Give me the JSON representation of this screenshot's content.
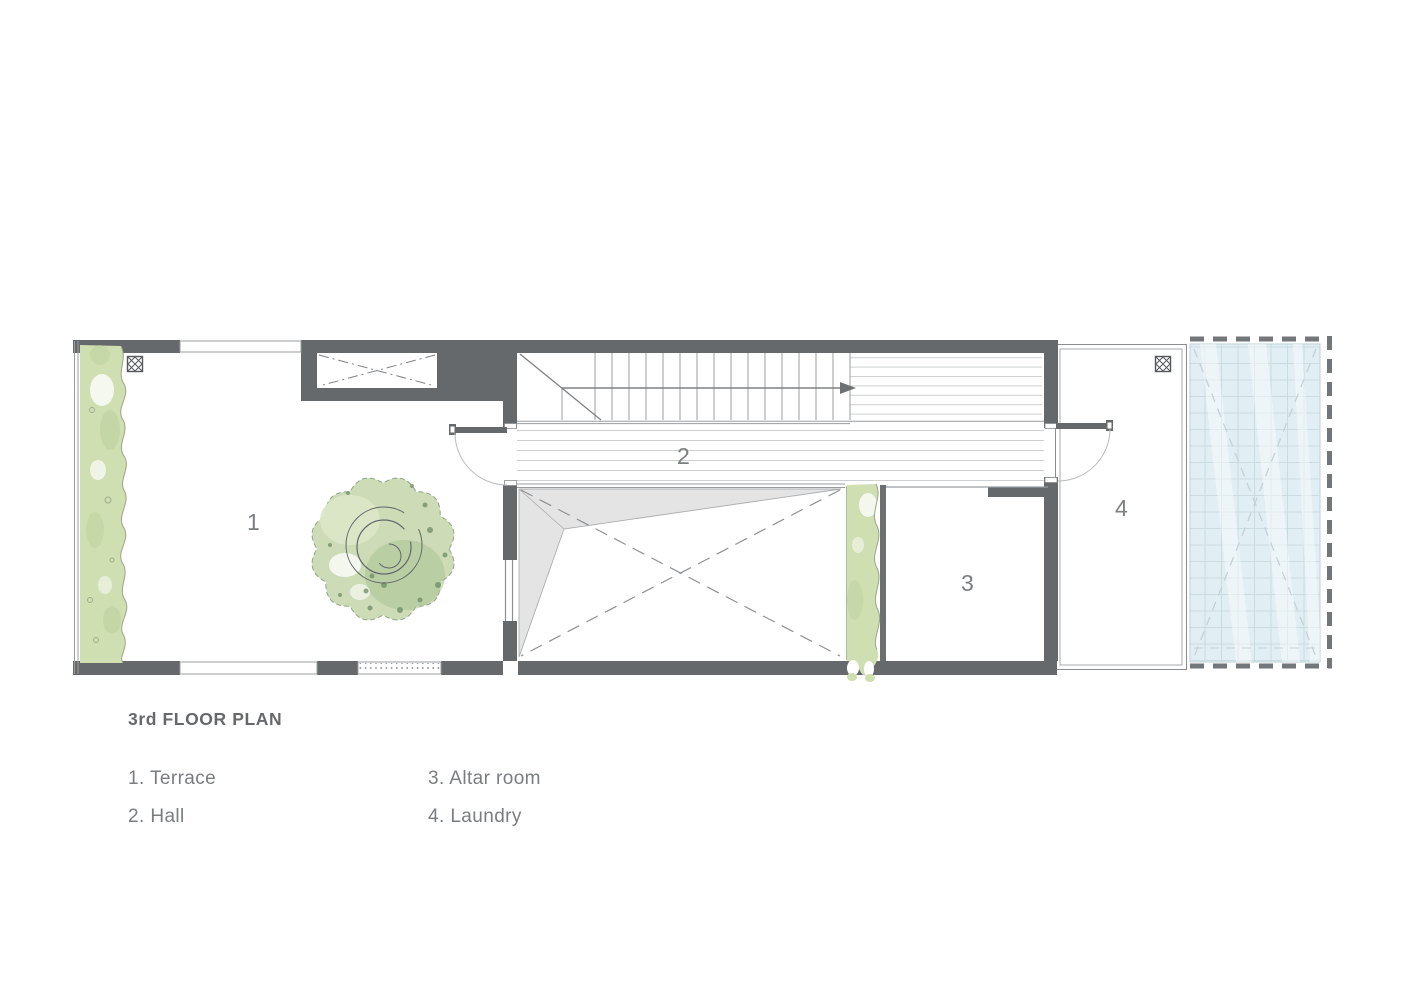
{
  "plan": {
    "title": "3rd FLOOR PLAN",
    "legend": [
      {
        "text": "1. Terrace"
      },
      {
        "text": "2. Hall"
      },
      {
        "text": "3. Altar room"
      },
      {
        "text": "4. Laundry"
      }
    ],
    "rooms": {
      "terrace": {
        "number": "1",
        "name": "Terrace"
      },
      "hall": {
        "number": "2",
        "name": "Hall"
      },
      "altar": {
        "number": "3",
        "name": "Altar room"
      },
      "laundry": {
        "number": "4",
        "name": "Laundry"
      }
    },
    "symbols": {
      "floor_drain": "crosshatched-square",
      "stair_direction": "arrow-up-to-right",
      "void_marker": "dashed-x-cross",
      "shaft_marker": "dash-dot-x-cross",
      "skylight": "glass-grid-with-x"
    },
    "colors": {
      "wall": "#65696c",
      "thin_line": "#9a9da0",
      "floor_line": "#cdcfd1",
      "planting_green": "#d0dfb2",
      "tree_green": "#c5d6aa",
      "skylight_blue": "#e1eef3",
      "shade_gray": "#e4e4e5",
      "label_text": "#7c7f82",
      "title_text": "#66686b"
    }
  }
}
